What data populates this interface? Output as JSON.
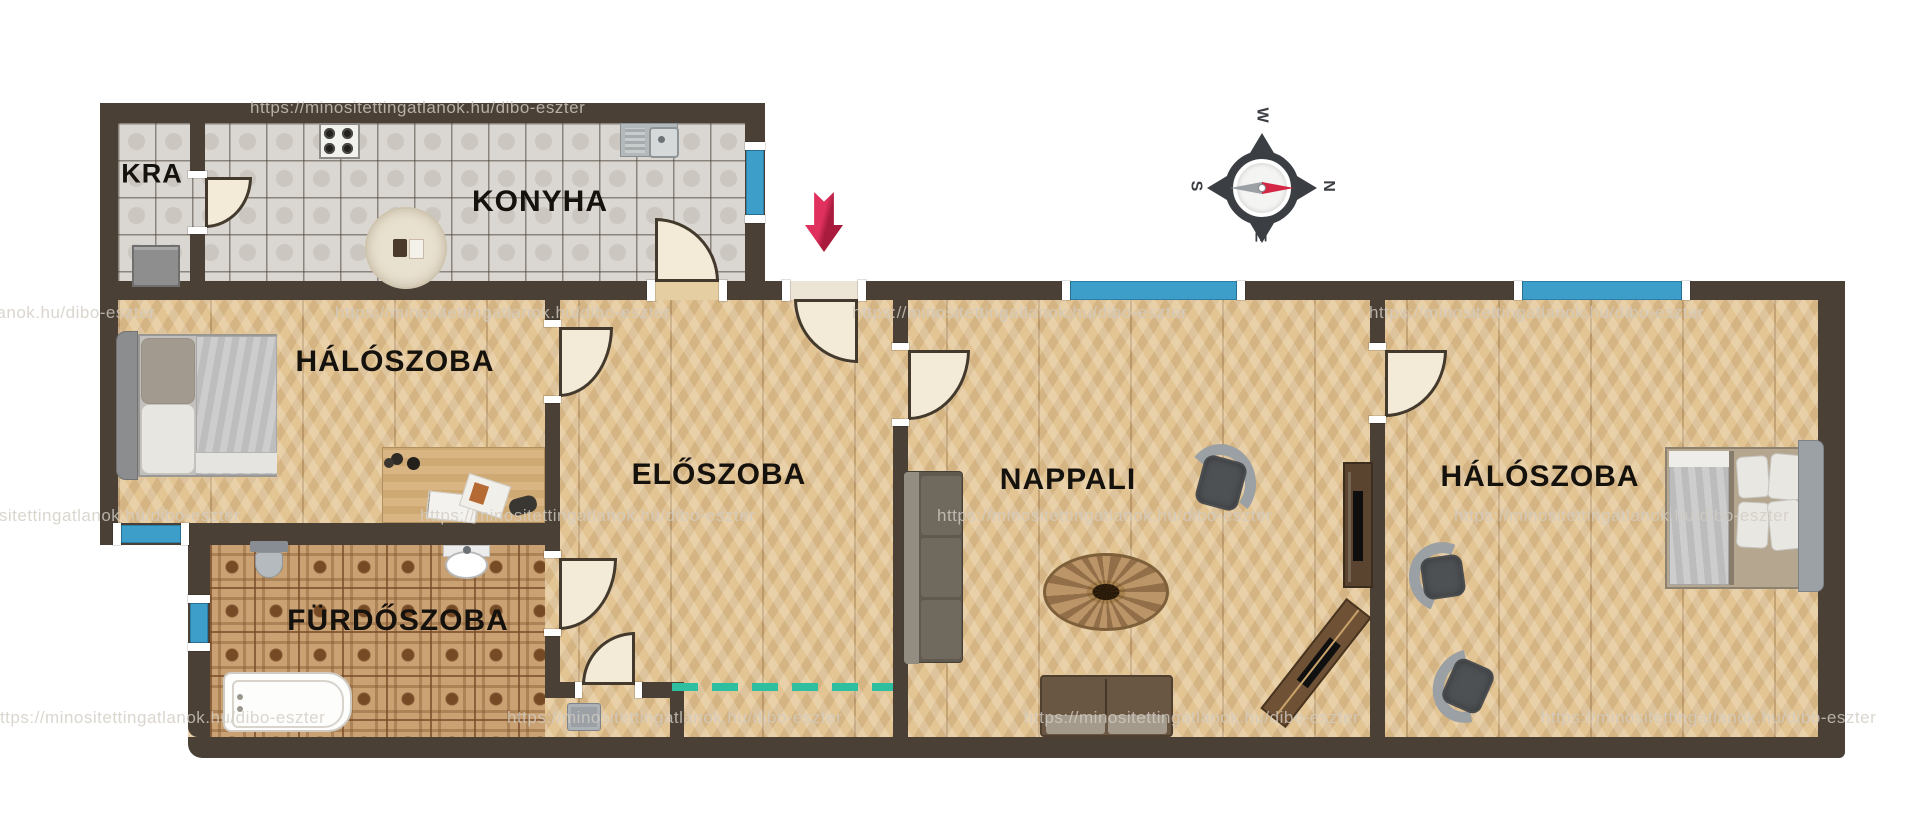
{
  "document": {
    "type": "apartment floor plan",
    "language": "Hungarian"
  },
  "rooms": [
    {
      "id": "kamra",
      "label": "KRA"
    },
    {
      "id": "konyha",
      "label": "KONYHA"
    },
    {
      "id": "haloszoba-1",
      "label": "HÁLÓSZOBA"
    },
    {
      "id": "eloszoba",
      "label": "ELŐSZOBA"
    },
    {
      "id": "furdoszoba",
      "label": "FÜRDŐSZOBA"
    },
    {
      "id": "nappali",
      "label": "NAPPALI"
    },
    {
      "id": "haloszoba-2",
      "label": "HÁLÓSZOBA"
    }
  ],
  "watermark": {
    "text": "https://minositettingatlanok.hu/dibo-eszter"
  },
  "compass": {
    "north": "N",
    "south": "S",
    "east": "E",
    "west": "W"
  },
  "colors": {
    "wall": "#4a4036",
    "window_glass": "#3d9ec9",
    "door_leaf": "#f3ead7",
    "entrance_arrow": "#d2234c",
    "virtual_boundary_dash": "#2ebfa0",
    "wood_floor": "#e3c493",
    "kitchen_tile": "#dad6d1",
    "bath_tile": "#c9a172"
  },
  "symbols": {
    "entrance_arrow": "entrance direction",
    "compass_needle_red": "points N (right)",
    "compass_needle_gray": "points S (left)"
  }
}
